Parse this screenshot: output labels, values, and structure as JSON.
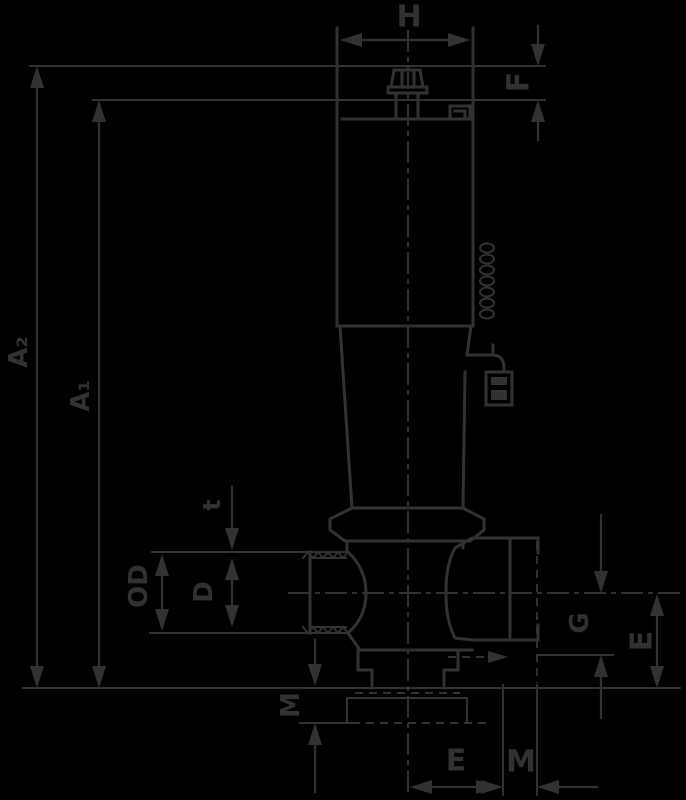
{
  "colors": {
    "background": "#000000",
    "line": "#353132"
  },
  "drawing": {
    "type": "technical-dimension-drawing",
    "subject": "valve-cross-section"
  },
  "dimensions": {
    "H": "H",
    "F": "F",
    "A2": "A₂",
    "A1": "A₁",
    "t": "t",
    "OD": "OD",
    "D": "D",
    "M_left": "M",
    "G": "G",
    "E_right": "E",
    "E_bottom": "E",
    "M_bottom": "M"
  }
}
